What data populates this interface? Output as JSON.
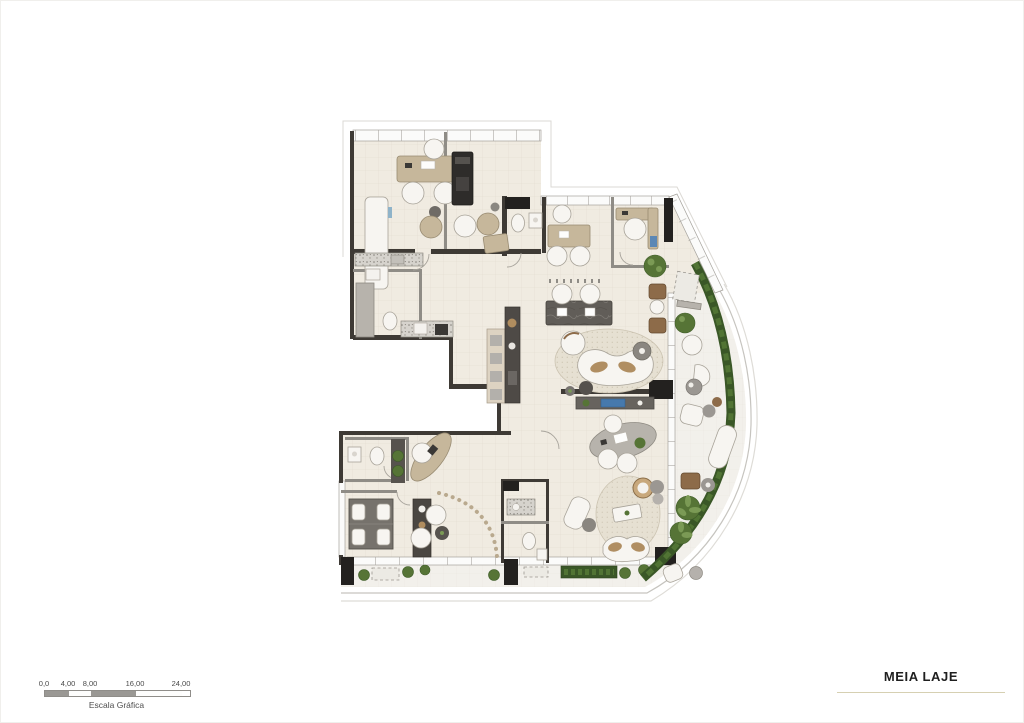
{
  "title_block": {
    "title": "MEIA LAJE"
  },
  "scale_bar": {
    "labels": [
      "0,0",
      "4,00",
      "8,00",
      "16,00",
      "24,00"
    ],
    "caption": "Escala Gráfica"
  },
  "colors": {
    "page_bg": "#ffffff",
    "floor": "#f0ebe1",
    "terrace": "#f2f0eb",
    "wall": "#3e3a35",
    "wood": "#c6b79b",
    "white_furn": "#f7f5f1",
    "dark_furn": "#67635e",
    "rug": "#e6e0d2",
    "plant": "#567436",
    "hedge": "#3a5727",
    "accent_underline": "#d6d0b2"
  }
}
